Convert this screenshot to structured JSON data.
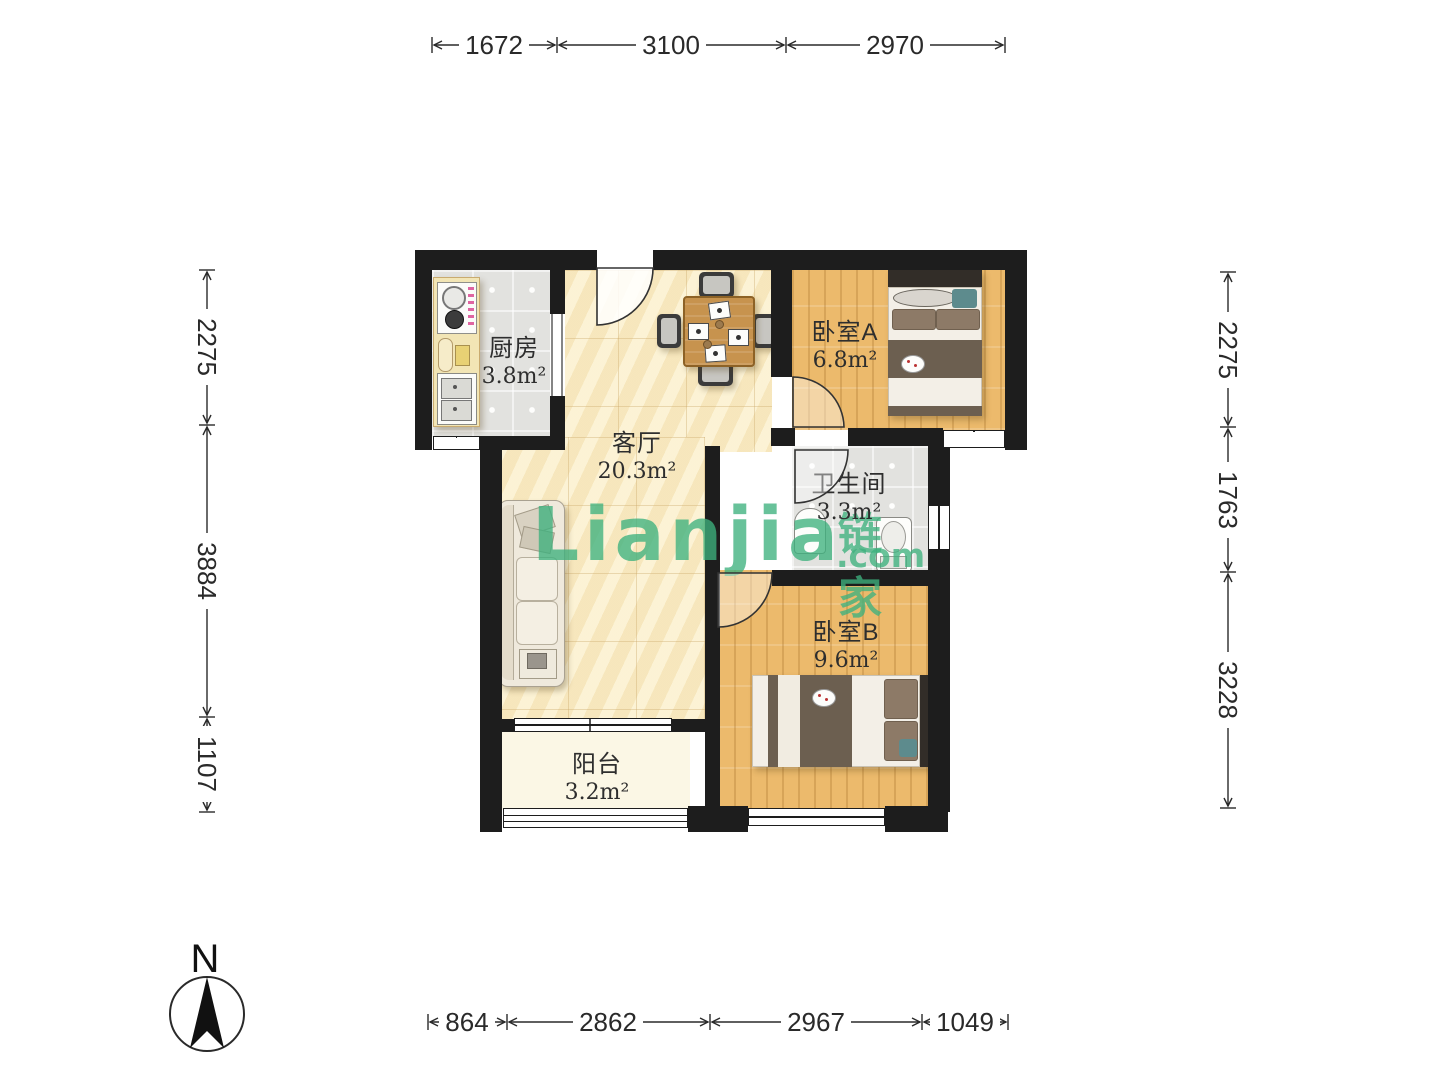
{
  "branding": {
    "watermark_main": "Lianjia",
    "watermark_cn": "链家",
    "watermark_domain": ".com",
    "watermark_color": "#3eb17d"
  },
  "compass": {
    "label": "N"
  },
  "rooms": {
    "kitchen": {
      "name": "厨房",
      "area": "3.8m²"
    },
    "living": {
      "name": "客厅",
      "area": "20.3m²"
    },
    "bedroom_a": {
      "name": "卧室A",
      "area": "6.8m²"
    },
    "bathroom": {
      "name": "卫生间",
      "area": "3.3m²"
    },
    "bedroom_b": {
      "name": "卧室B",
      "area": "9.6m²"
    },
    "balcony": {
      "name": "阳台",
      "area": "3.2m²"
    }
  },
  "dimensions": {
    "top": [
      "1672",
      "3100",
      "2970"
    ],
    "bottom": [
      "864",
      "2862",
      "2967",
      "1049"
    ],
    "left": [
      "2275",
      "3884",
      "1107"
    ],
    "right": [
      "2275",
      "1763",
      "3228"
    ]
  },
  "colors": {
    "wall": "#1d1d1d",
    "marble_floor": "#f8ecc7",
    "wood_floor": "#ecba6c",
    "tile_floor": "#e2e2df",
    "balcony_floor": "#fbf7e5",
    "dimension_text": "#2a2a2a"
  }
}
